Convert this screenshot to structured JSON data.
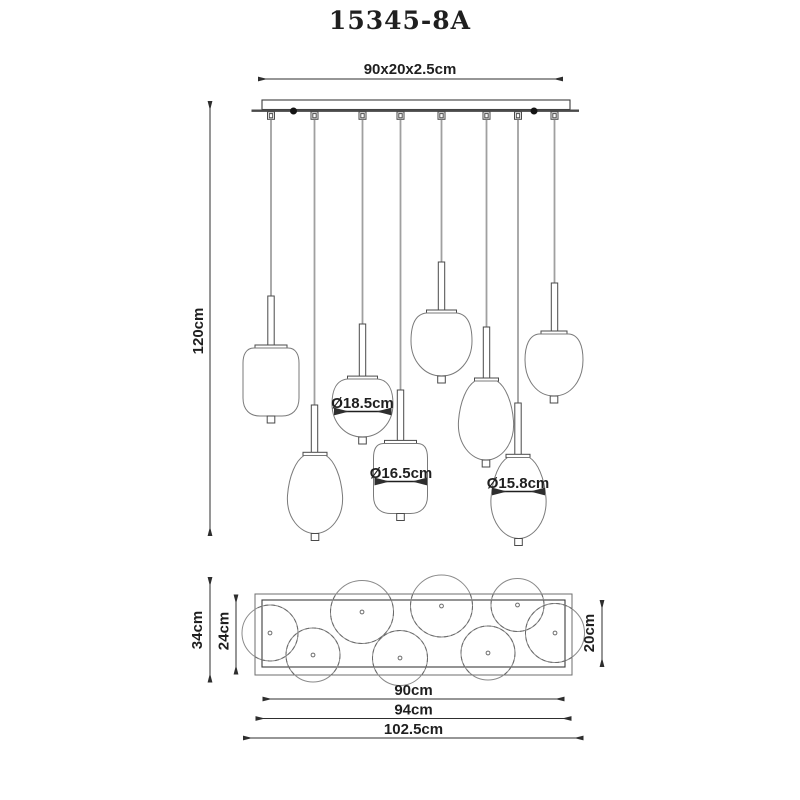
{
  "title": "15345-8A",
  "colors": {
    "ink": "#3c3c3c",
    "cord": "#a0a0a0",
    "background": "#ffffff"
  },
  "front_view": {
    "lamp_count": 8,
    "plate_size": "90x20x2.5cm",
    "drop_height": "120cm",
    "dia_large": "Ø18.5cm",
    "dia_medium": "Ø16.5cm",
    "dia_small": "Ø15.8cm"
  },
  "top_view": {
    "overall_depth": "34cm",
    "frame_depth": "24cm",
    "plate_depth": "20cm",
    "plate_width": "90cm",
    "frame_width": "94cm",
    "overall_width": "102.5cm"
  }
}
